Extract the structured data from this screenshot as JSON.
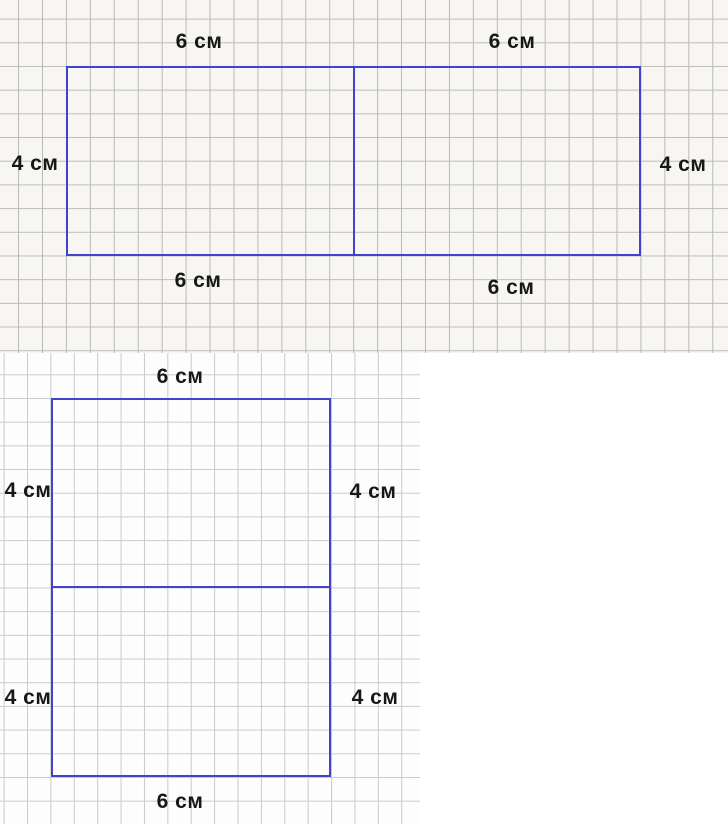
{
  "page": {
    "description": "Grid-paper geometry diagrams: a wide rectangle made of two 6 cm by 4 cm parts placed side by side, and a tall rectangle made of two 6 cm by 4 cm parts stacked vertically.",
    "unit": "см"
  },
  "figure_wide": {
    "top_labels": [
      "6 см",
      "6 см"
    ],
    "left_label": "4 см",
    "right_label": "4 см",
    "bottom_labels": [
      "6 см",
      "6 см"
    ],
    "parts": 2,
    "part_width_cm": 6,
    "part_height_cm": 4
  },
  "figure_tall": {
    "top_label": "6 см",
    "left_labels": [
      "4 см",
      "4 см"
    ],
    "right_labels": [
      "4 см",
      "4 см"
    ],
    "bottom_label": "6 см",
    "parts": 2,
    "part_width_cm": 6,
    "part_height_cm": 4
  },
  "colors": {
    "rectangle_stroke": "#4242cc",
    "grid_line_top_section": "#bdbdbd",
    "grid_line_bottom_section": "#cbcbcb",
    "paper_top": "#f7f6f3",
    "paper_bottom": "#fdfdfd",
    "label_text": "#171717"
  }
}
